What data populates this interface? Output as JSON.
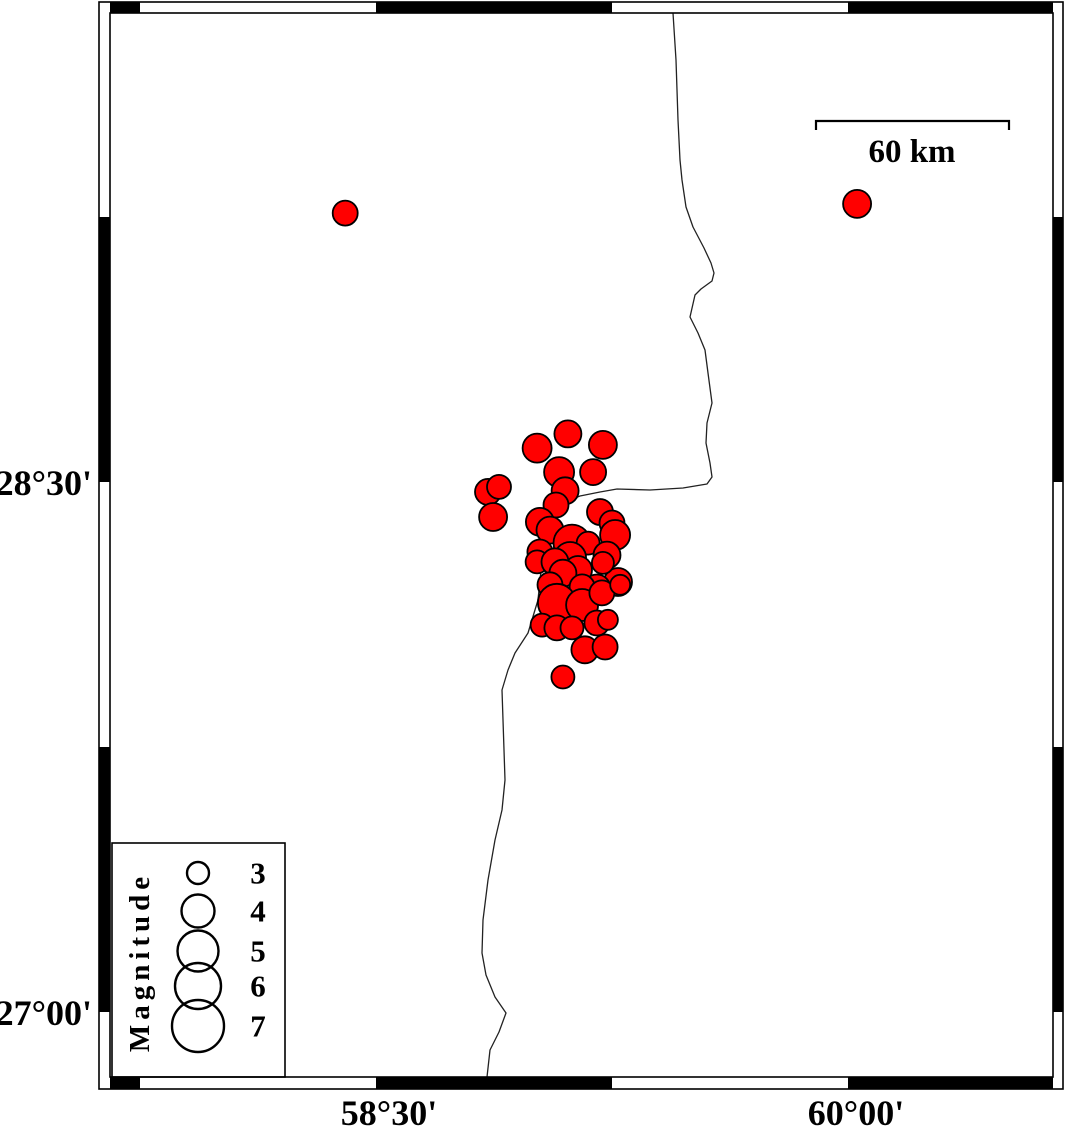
{
  "chart_data": {
    "type": "scatter",
    "subtype": "earthquake-epicenter-map",
    "title": "",
    "xlabel": "",
    "ylabel": "",
    "axes": {
      "x": {
        "tick_labels": [
          "58°30'",
          "60°00'"
        ],
        "labels": [
          {
            "text": "58°30'",
            "x": 389
          },
          {
            "text": "60°00'",
            "x": 856
          }
        ],
        "tick_interval_minutes": 45
      },
      "y": {
        "tick_labels": [
          "28°30'",
          "27°00'"
        ],
        "labels": [
          {
            "text": "28°30'",
            "y": 483
          },
          {
            "text": "27°00'",
            "y": 1013
          }
        ],
        "tick_interval_minutes": 45
      }
    },
    "calibration": {
      "x0_px": 376,
      "lon0": 58.5,
      "px_per_lon": 314.667,
      "y0_px": 482,
      "lat0": 28.5,
      "px_per_lat": 353.333
    },
    "frame": {
      "outer": [
        99,
        2,
        1063,
        1089
      ],
      "inner": [
        110,
        13,
        1053,
        1077
      ],
      "x_tick_boundaries_px": [
        140,
        376,
        612,
        848
      ],
      "y_tick_boundaries_px": [
        217,
        482,
        747,
        1012
      ],
      "x_first_segment_black": true,
      "y_first_segment_black": false
    },
    "scale_bar": {
      "label": "60 km",
      "x1": 816,
      "x2": 1009,
      "y": 121,
      "tick_drop": 9,
      "label_x": 912,
      "label_y": 152
    },
    "legend": {
      "title": "Magnitude",
      "box": {
        "x": 112,
        "y": 843,
        "w": 173,
        "h": 234
      },
      "title_x": 140,
      "title_y": 962,
      "circle_x": 198,
      "value_x": 258,
      "entries": [
        {
          "value": "3",
          "y": 873,
          "d": 22
        },
        {
          "value": "4",
          "y": 911,
          "d": 33
        },
        {
          "value": "5",
          "y": 951,
          "d": 41
        },
        {
          "value": "6",
          "y": 986,
          "d": 46
        },
        {
          "value": "7",
          "y": 1026,
          "d": 52
        }
      ]
    },
    "colors": {
      "point_fill": "#ff0000",
      "point_stroke": "#000000",
      "coastline": "#222222",
      "frame": "#000000",
      "background": "#ffffff"
    },
    "point_format": [
      "lon",
      "lat",
      "diameter_px"
    ],
    "points": [
      [
        58.402,
        29.261,
        25
      ],
      [
        60.029,
        29.287,
        28
      ],
      [
        59.012,
        28.596,
        29
      ],
      [
        59.11,
        28.636,
        27
      ],
      [
        59.221,
        28.605,
        28
      ],
      [
        59.082,
        28.528,
        30
      ],
      [
        59.19,
        28.528,
        26
      ],
      [
        58.856,
        28.472,
        26
      ],
      [
        58.891,
        28.486,
        24
      ],
      [
        58.872,
        28.401,
        28
      ],
      [
        59.101,
        28.475,
        27
      ],
      [
        59.072,
        28.435,
        25
      ],
      [
        59.021,
        28.387,
        28
      ],
      [
        59.053,
        28.364,
        27
      ],
      [
        59.212,
        28.415,
        26
      ],
      [
        59.25,
        28.384,
        25
      ],
      [
        59.26,
        28.35,
        30
      ],
      [
        59.123,
        28.327,
        37
      ],
      [
        59.174,
        28.327,
        23
      ],
      [
        59.234,
        28.293,
        27
      ],
      [
        59.021,
        28.302,
        25
      ],
      [
        59.012,
        28.274,
        23
      ],
      [
        59.117,
        28.285,
        32
      ],
      [
        59.069,
        28.274,
        27
      ],
      [
        59.142,
        28.251,
        28
      ],
      [
        59.094,
        28.242,
        27
      ],
      [
        59.269,
        28.217,
        28
      ],
      [
        59.202,
        28.2,
        27
      ],
      [
        59.155,
        28.203,
        25
      ],
      [
        59.053,
        28.209,
        25
      ],
      [
        59.221,
        28.271,
        22
      ],
      [
        59.075,
        28.158,
        38
      ],
      [
        59.155,
        28.152,
        32
      ],
      [
        59.218,
        28.186,
        25
      ],
      [
        59.276,
        28.209,
        20
      ],
      [
        59.028,
        28.095,
        23
      ],
      [
        59.075,
        28.087,
        25
      ],
      [
        59.123,
        28.087,
        23
      ],
      [
        59.202,
        28.101,
        25
      ],
      [
        59.237,
        28.11,
        20
      ],
      [
        59.164,
        28.025,
        27
      ],
      [
        59.228,
        28.033,
        25
      ],
      [
        59.094,
        27.948,
        23
      ]
    ],
    "basemap": {
      "coastline_px": [
        [
          673,
          13
        ],
        [
          676,
          60
        ],
        [
          678,
          120
        ],
        [
          680,
          160
        ],
        [
          682,
          180
        ],
        [
          686,
          207
        ],
        [
          693,
          227
        ],
        [
          704,
          248
        ],
        [
          711,
          263
        ],
        [
          714,
          273
        ],
        [
          712,
          281
        ],
        [
          701,
          289
        ],
        [
          695,
          295
        ],
        [
          690,
          317
        ],
        [
          698,
          333
        ],
        [
          705,
          350
        ],
        [
          708,
          373
        ],
        [
          712,
          403
        ],
        [
          707,
          423
        ],
        [
          706,
          443
        ],
        [
          710,
          463
        ],
        [
          712,
          477
        ],
        [
          707,
          484
        ],
        [
          683,
          488
        ],
        [
          650,
          490
        ],
        [
          617,
          489
        ],
        [
          600,
          492
        ],
        [
          580,
          496
        ],
        [
          565,
          502
        ],
        [
          556,
          512
        ],
        [
          549,
          524
        ],
        [
          544,
          545
        ],
        [
          541,
          570
        ],
        [
          538,
          600
        ],
        [
          528,
          633
        ],
        [
          515,
          653
        ],
        [
          508,
          670
        ],
        [
          502,
          690
        ],
        [
          503,
          720
        ],
        [
          505,
          780
        ],
        [
          502,
          810
        ],
        [
          495,
          840
        ],
        [
          488,
          880
        ],
        [
          483,
          920
        ],
        [
          482,
          953
        ],
        [
          486,
          975
        ],
        [
          495,
          997
        ],
        [
          506,
          1013
        ],
        [
          499,
          1032
        ],
        [
          490,
          1050
        ],
        [
          487,
          1077
        ]
      ]
    }
  }
}
